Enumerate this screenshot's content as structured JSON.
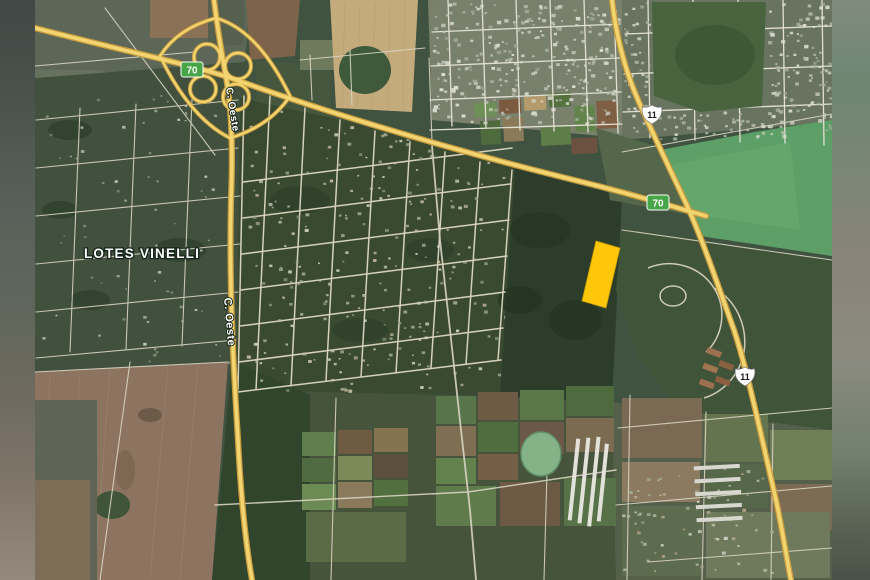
{
  "map": {
    "area_label": "LOTES VINELLI",
    "road_labels": {
      "north": "C. Oeste",
      "south": "C. Oeste"
    },
    "shields": {
      "route70_a": "70",
      "route70_b": "70",
      "route11_a": "11",
      "route11_b": "11"
    },
    "colors": {
      "highlight_parcel": "#FFC60A",
      "highway_fill": "#F2D470",
      "highway_casing": "#C79C3E",
      "shield_green": "#46A546",
      "shield_white": "#FFFFFF",
      "label_text": "#FFFFFF"
    }
  }
}
